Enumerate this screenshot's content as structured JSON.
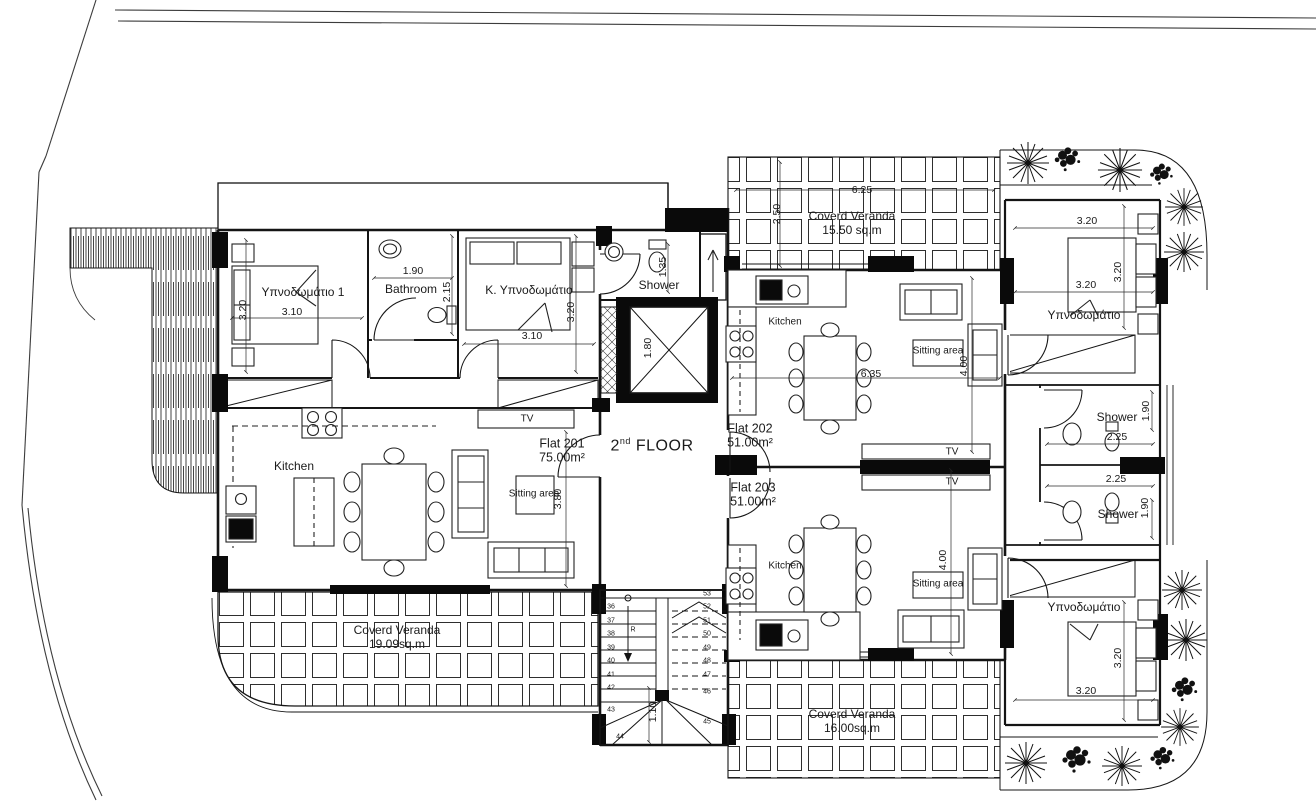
{
  "plan": {
    "title": {
      "num": "2",
      "sup": "nd",
      "rest": " FLOOR"
    },
    "flats": {
      "f201": {
        "name": "Flat 201",
        "area": "75.00m²"
      },
      "f202": {
        "name": "Flat 202",
        "area": "51.00m²"
      },
      "f203": {
        "name": "Flat 203",
        "area": "51.00m²"
      }
    },
    "rooms": {
      "bedroom1": "Υπνοδωμάτιο 1",
      "bathroom": "Bathroom",
      "master_bedroom": "Κ. Υπνοδωμάτιο",
      "shower": "Shower",
      "kitchen": "Kitchen",
      "sitting_area": "Sitting area",
      "bedroom": "Υπνοδωμάτιο",
      "tv": "TV"
    },
    "verandas": {
      "v201": {
        "line1": "Coverd Veranda",
        "line2": "19.09sq.m"
      },
      "v202": {
        "line1": "Coverd Veranda",
        "line2": "15.50 sq.m"
      },
      "v203": {
        "line1": "Coverd Veranda",
        "line2": "16.00sq.m"
      }
    },
    "dims": {
      "d310": "3.10",
      "d320": "3.20",
      "d190": "1.90",
      "d215": "2.15",
      "d135": "1.35",
      "d180": "1.80",
      "d625": "6.25",
      "d250": "2.50",
      "d635": "6.35",
      "d400": "4.00",
      "d380": "3.80",
      "d225": "2.25",
      "d110": "1.10"
    },
    "stairs": {
      "r_label": "R",
      "left": [
        "36",
        "37",
        "38",
        "39",
        "40",
        "41",
        "42",
        "43",
        "44"
      ],
      "right": [
        "53",
        "52",
        "51",
        "50",
        "49",
        "48",
        "47",
        "46",
        "45"
      ]
    },
    "colors": {
      "line": "#161616",
      "background": "#ffffff"
    }
  }
}
